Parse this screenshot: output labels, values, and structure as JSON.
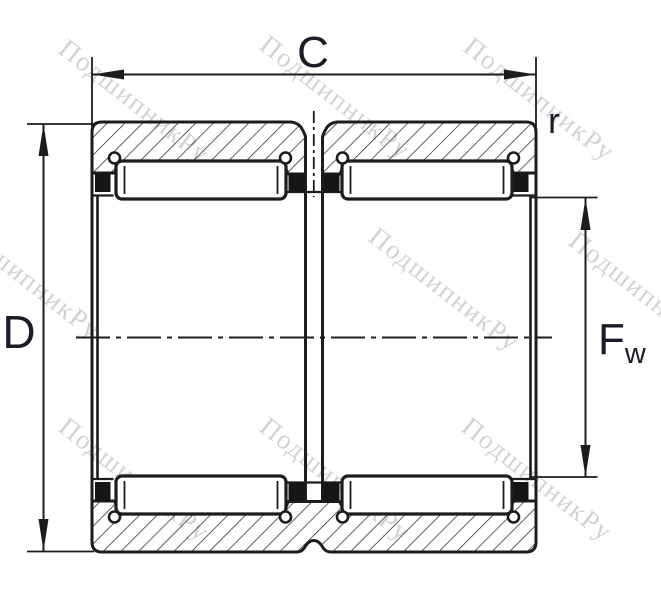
{
  "drawing": {
    "title": "Double-row needle roller bearing cross-section",
    "labels": {
      "outer_width": "C",
      "outer_diameter": "D",
      "corner_radius": "r",
      "bore_diameter_main": "F",
      "bore_diameter_sub": "w"
    },
    "watermark_text": "ПодшипникРу",
    "colors": {
      "line": "#1c1c1c",
      "label": "#1a1d28",
      "watermark": "#d3d3d3",
      "background": "#ffffff"
    }
  }
}
